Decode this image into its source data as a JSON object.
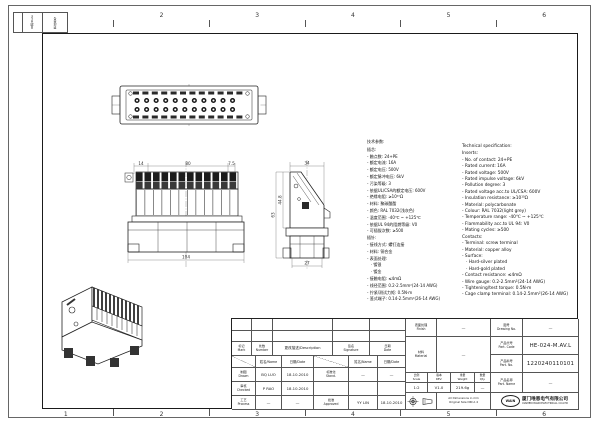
{
  "sheet": {
    "grid_numbers": [
      "1",
      "2",
      "3",
      "4",
      "5",
      "6"
    ],
    "corner_strip": {
      "date_label": "日期/Date",
      "doc_label": "更改单号"
    }
  },
  "views": {
    "front": {
      "dim_left": "14",
      "dim_center": "80",
      "dim_right": "7.5",
      "dim_bottom": "104"
    },
    "side": {
      "dim_top": "34",
      "dim_outer": "63",
      "dim_inner": "44.8",
      "dim_bottom": "27"
    }
  },
  "specs": {
    "cn": {
      "title": "技术参数:",
      "lines": [
        "插芯:",
        "- 触点数: 24+PE",
        "- 额定电流: 16A",
        "- 额定电压: 500V",
        "- 额定脉冲电压: 6kV",
        "- 污染等级: 3",
        "- 依据UL/CSA的额定电压: 600V",
        "- 绝缘电阻: ≥10¹⁰Ω",
        "- 材料: 聚碳酸酯",
        "- 颜色: RAL 7032(浅灰色)",
        "- 温度范围: -40℃ ~ +125℃",
        "- 依据UL 94的阻燃等级: V0",
        "- 可插拔次数: ≥500",
        "插针:",
        "- 接线方式: 螺钉连接",
        "- 材料: 铜合金",
        "- 表面处理:",
        "   · 镀银",
        "   · 镀金",
        "- 接触电阻: ≤4mΩ",
        "- 线径范围: 0.2-2.5mm²(24-14 AWG)",
        "- 拧紧/测试力矩: 0.5N·m",
        "- 笼式端子: 0.14-2.5mm²(26-14 AWG)"
      ]
    },
    "en": {
      "title": "Technical specification:",
      "lines": [
        "Inserts:",
        "- No. of contact: 24+PE",
        "- Rated current: 16A",
        "- Rated voltage: 500V",
        "- Rated impulse voltage: 6kV",
        "- Pollution degree: 3",
        "- Rated voltage acc.to UL/CSA: 600V",
        "- Insulation resistance: ≥10¹⁰Ω",
        "- Material: polycarbonate",
        "- Colour: RAL 7032(light grey)",
        "- Temperature range: -40℃ ~ +125℃",
        "- Flammability acc.to UL 94: V0",
        "- Mating cycles: ≥500",
        "Contacts:",
        "- Terminal: screw terminal",
        "- Material: copper alloy",
        "- Surface:",
        "   · Hard-silver plated",
        "   · Hard-gold plated",
        "- Contact resistance: ≤4mΩ",
        "- Wire gauge: 0.2-2.5mm²(24-14 AWG)",
        "- Tightening/test torque: 0.5N·m",
        "- Cage clamp terminal: 0.14-2.5mm²(26-14 AWG)"
      ]
    }
  },
  "title_block": {
    "rev_table": {
      "mark": "标记\nMark",
      "number": "处数\nNumber",
      "description": "更改描述/Description",
      "signature": "签名\nSignature",
      "date": "日期\nDate",
      "name_sub": "姓名/Name",
      "date_sub": "日期/Date"
    },
    "approval": {
      "drawn_label": "制图\nDrawn",
      "drawn_name": "BQ LUO",
      "drawn_date": "18.10.2010",
      "checked_label": "审核\nChecked",
      "checked_name": "P RAO",
      "checked_date": "18.10.2010",
      "process_label": "工艺\nProcess",
      "process_name": "—",
      "process_date": "—",
      "standard_label": "标准化\nStand.",
      "standard_name": "—",
      "standard_date": "—",
      "approved_label": "批准\nApproved",
      "approved_name": "YY LIN",
      "approved_date": "18.10.2010"
    },
    "info": {
      "finish_label": "表面处理\nFinish",
      "finish_value": "—",
      "material_label": "材料\nMaterial",
      "material_value": "—",
      "drawing_no_label": "图号\nDrawing No.",
      "drawing_no_value": "—",
      "part_code_label": "产品代号\nPart. Code",
      "part_code_value": "HE-024-M.AV.L",
      "part_no_label": "产品料号\nPart. No.",
      "part_no_value": "1220240110101",
      "part_name_label": "产品名称\nPart. Name",
      "part_name_value": "—",
      "scale_label": "比例\nScale",
      "scale_value": "1:2",
      "rev_label": "版本\nREV.",
      "rev_value": "V1.0",
      "weight_label": "重量\nWeight",
      "weight_value": "219.6g",
      "qty_label": "数量\nQty.",
      "qty_value": "—",
      "dims_note": "All Dimensions in mm\nOriginal Size DIN A 4"
    },
    "company": {
      "logo": "WAIN",
      "name_cn": "厦门唯恩电气有限公司",
      "name_en": "XIAMEN WAIN ELECTRICAL CO.LTD"
    }
  }
}
